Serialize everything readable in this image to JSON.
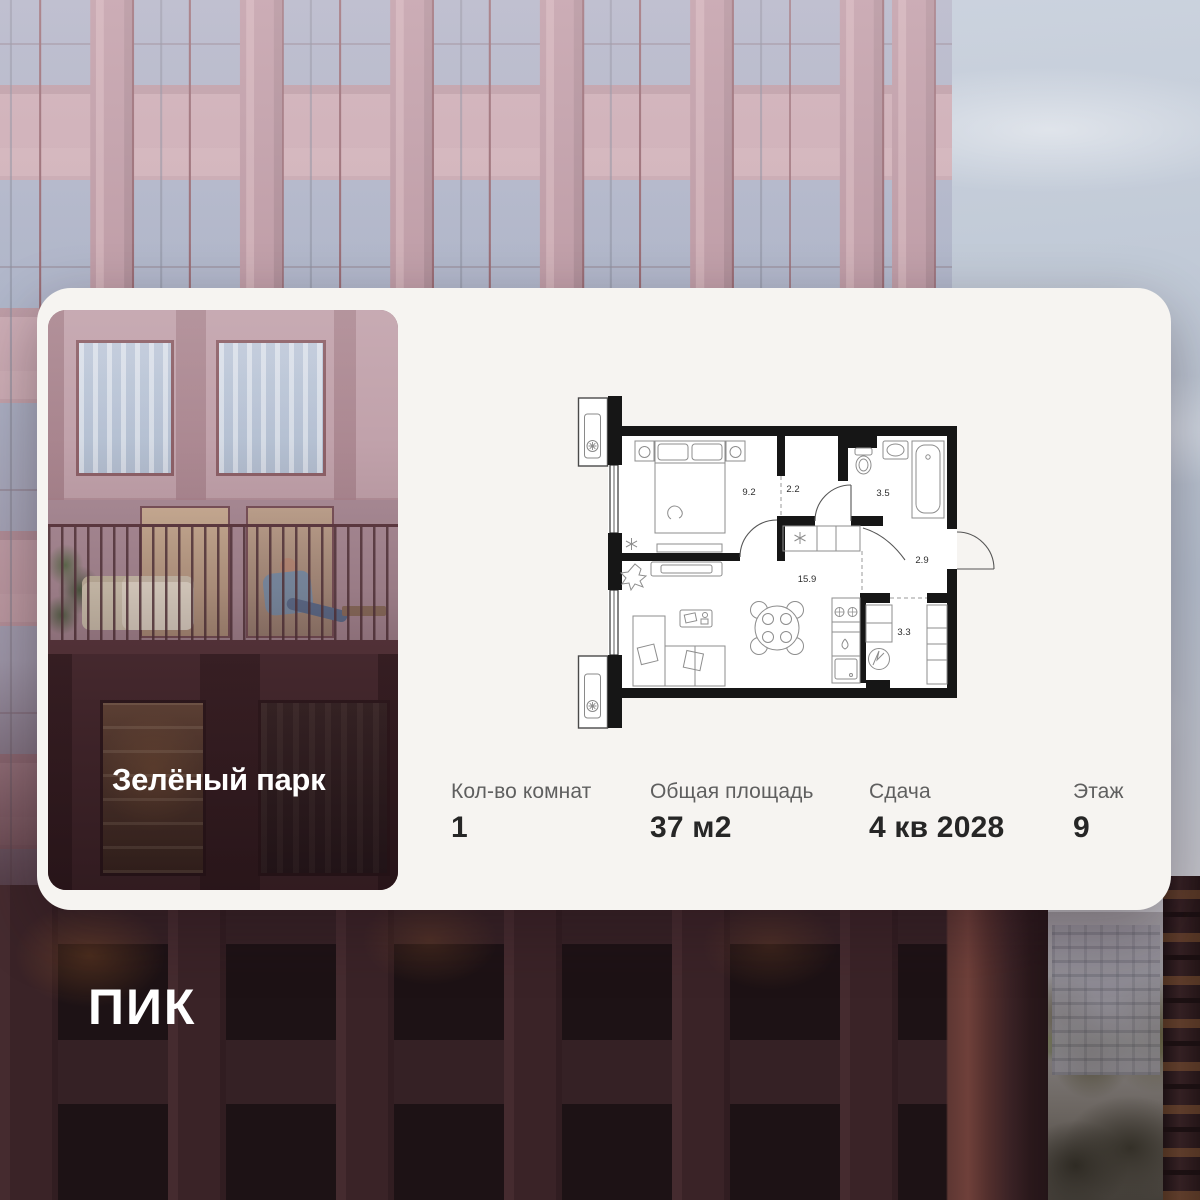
{
  "brand": {
    "logo_text": "ПИК"
  },
  "project": {
    "name": "Зелёный парк"
  },
  "floor_plan": {
    "rooms": [
      "9.2",
      "2.2",
      "3.5",
      "2.9",
      "15.9",
      "3.3"
    ]
  },
  "specs": [
    {
      "label": "Кол-во комнат",
      "value": "1"
    },
    {
      "label": "Общая площадь",
      "value": "37 м2"
    },
    {
      "label": "Сдача",
      "value": "4 кв 2028"
    },
    {
      "label": "Этаж",
      "value": "9"
    }
  ],
  "colors": {
    "card_bg": "#f6f4f1",
    "text_primary": "#262626",
    "text_secondary": "#5f5f5f",
    "plan_walls": "#161616",
    "facade_pink": "#bb9aa4",
    "facade_dark": "#2a181b",
    "brand_white": "#ffffff"
  }
}
